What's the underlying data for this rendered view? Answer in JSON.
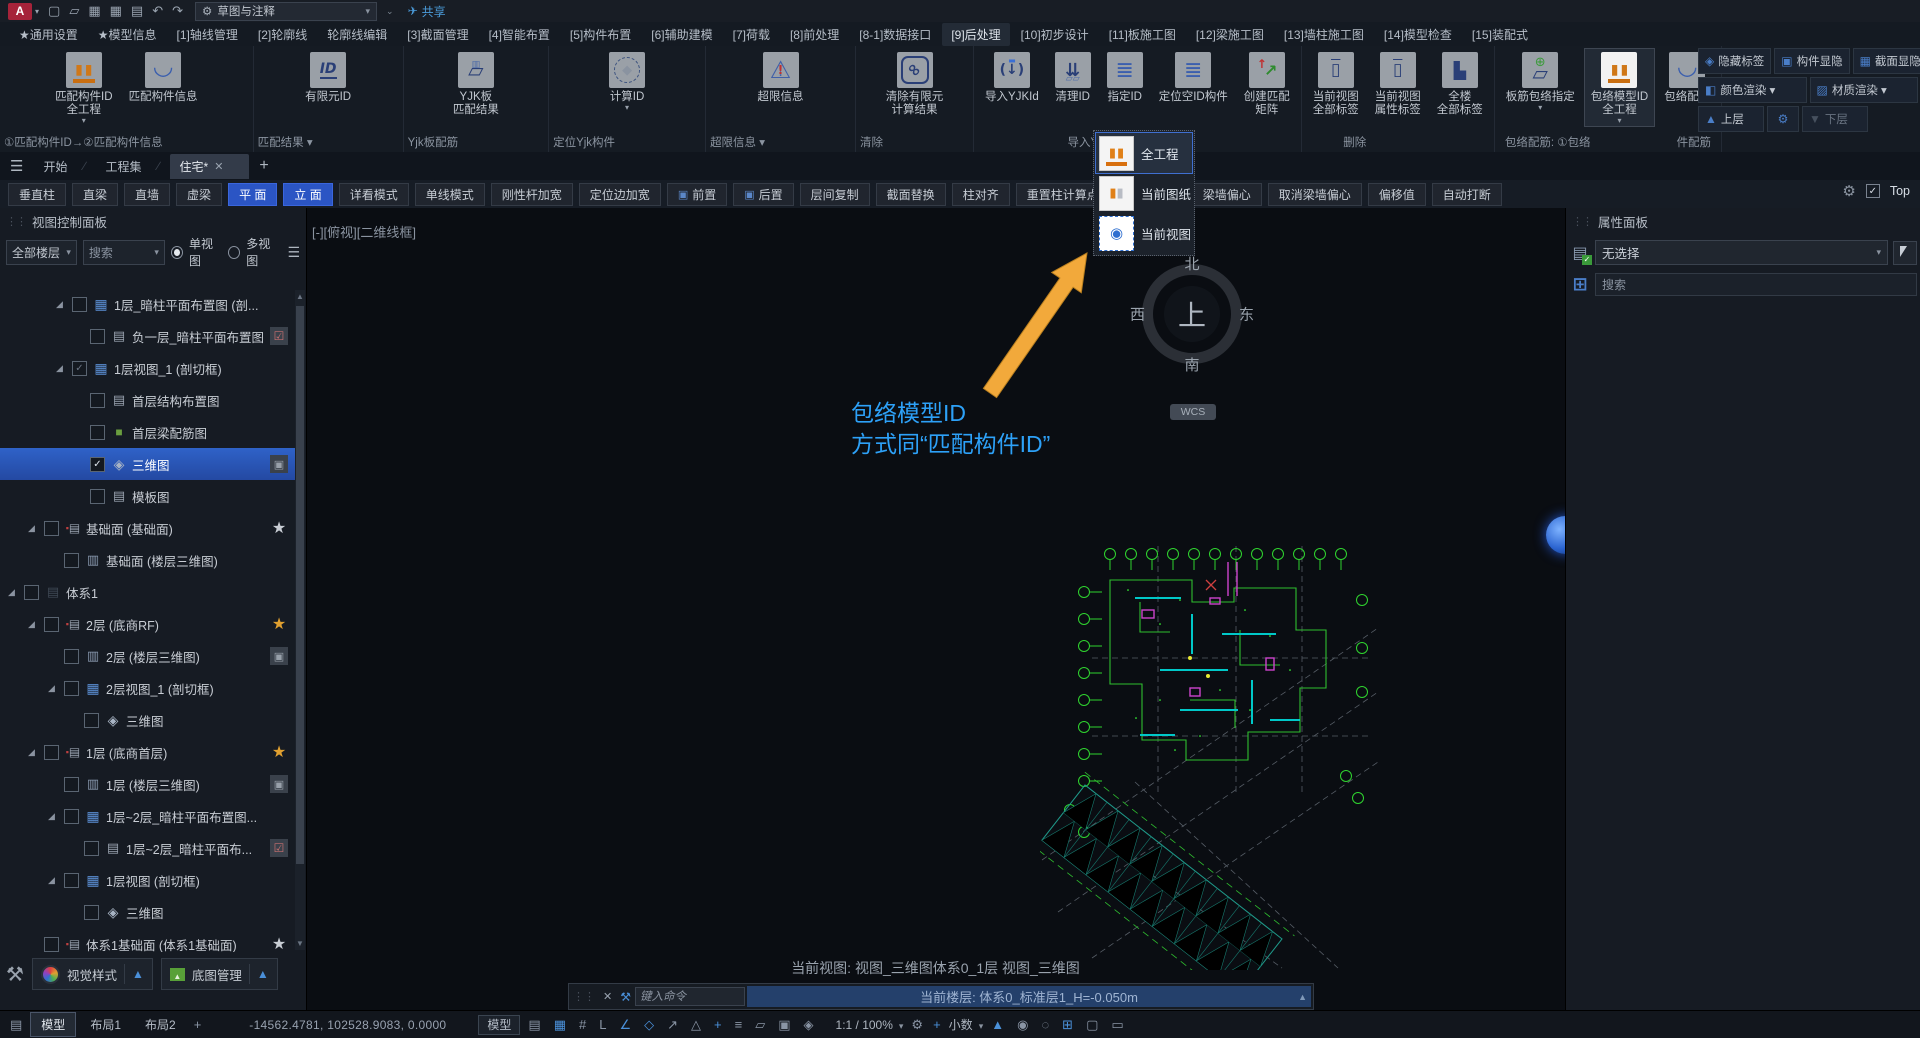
{
  "titlebar": {
    "app_initial": "A",
    "workspace": "草图与注释",
    "share_label": "共享",
    "doc_title": "广州贯微·小迅  住宅.dwg",
    "search_placeholder": "键入关键字或短语",
    "login_label": "登录",
    "account_initial": "A",
    "help_glyph": "?",
    "minimize_glyph": "—",
    "maximize_glyph": "❐",
    "close_glyph": "✕",
    "quick_icons": [
      {
        "name": "new-file-icon",
        "glyph": "▢"
      },
      {
        "name": "open-folder-icon",
        "glyph": "▱"
      },
      {
        "name": "save-icon",
        "glyph": "▦"
      },
      {
        "name": "save-as-icon",
        "glyph": "▦"
      },
      {
        "name": "print-icon",
        "glyph": "▤"
      },
      {
        "name": "undo-icon",
        "glyph": "↶"
      },
      {
        "name": "redo-icon",
        "glyph": "↷"
      }
    ]
  },
  "menubar": {
    "items": [
      {
        "label": "★通用设置"
      },
      {
        "label": "★模型信息"
      },
      {
        "label": "[1]轴线管理"
      },
      {
        "label": "[2]轮廓线"
      },
      {
        "label": "轮廓线编辑"
      },
      {
        "label": "[3]截面管理"
      },
      {
        "label": "[4]智能布置"
      },
      {
        "label": "[5]构件布置"
      },
      {
        "label": "[6]辅助建模"
      },
      {
        "label": "[7]荷载"
      },
      {
        "label": "[8]前处理"
      },
      {
        "label": "[8-1]数据接口"
      },
      {
        "label": "[9]后处理",
        "active": "1"
      },
      {
        "label": "[10]初步设计"
      },
      {
        "label": "[11]板施工图"
      },
      {
        "label": "[12]梁施工图"
      },
      {
        "label": "[13]墙柱施工图"
      },
      {
        "label": "[14]模型检查"
      },
      {
        "label": "[15]装配式"
      }
    ],
    "overflow_glyph": "»",
    "layout_label": "功能布局:",
    "layout_value": "默认"
  },
  "ribbon": {
    "groups": [
      {
        "label": "①匹配构件ID→②匹配构件信息",
        "buttons": [
          {
            "label": "匹配构件ID\n全工程",
            "icon": "columns",
            "arrow": "1"
          },
          {
            "label": "匹配构件信息",
            "icon": "wave"
          }
        ]
      },
      {
        "label": "匹配结果 ▾",
        "buttons": [
          {
            "label": "有限元ID",
            "icon": "id"
          }
        ]
      },
      {
        "label": "Yjk板配筋",
        "buttons": [
          {
            "label": "YJK板\n匹配结果",
            "icon": "plate"
          }
        ]
      },
      {
        "label": "定位Yjk构件",
        "buttons": [
          {
            "label": "计算ID",
            "icon": "calc",
            "arrow": "1"
          }
        ]
      },
      {
        "label": "超限信息 ▾",
        "buttons": [
          {
            "label": "超限信息",
            "icon": "warning"
          }
        ]
      },
      {
        "label": "清除",
        "buttons": [
          {
            "label": "清除有限元\n计算结果",
            "icon": "link"
          }
        ]
      },
      {
        "label": "导入YJKId",
        "buttons": [
          {
            "label": "导入YJKId",
            "icon": "import"
          },
          {
            "label": "清理ID",
            "icon": "cleanid"
          },
          {
            "label": "指定ID",
            "icon": "assignid"
          },
          {
            "label": "定位空ID构件",
            "icon": "locateid"
          },
          {
            "label": "创建匹配\n矩阵",
            "icon": "matrix"
          }
        ]
      },
      {
        "label": "删除",
        "buttons": [
          {
            "label": "当前视图\n全部标签",
            "icon": "trash"
          },
          {
            "label": "当前视图\n属性标签",
            "icon": "trash"
          },
          {
            "label": "全楼\n全部标签",
            "icon": "dozer"
          }
        ]
      },
      {
        "label": "包络配筋: ①包络",
        "label_right": "件配筋",
        "buttons": [
          {
            "label": "板筋包络指定",
            "icon": "plateenv",
            "arrow": "1"
          },
          {
            "label": "包络模型ID\n全工程",
            "icon": "columnsw",
            "arrow": "1",
            "active": "1"
          },
          {
            "label": "包络配筋",
            "icon": "wave"
          }
        ]
      }
    ]
  },
  "view_controls": {
    "row1": [
      {
        "label": "隐藏标签",
        "icon_glyph": "◈",
        "icon_name": "hide-tag-icon"
      },
      {
        "label": "构件显隐",
        "icon_glyph": "▣",
        "icon_name": "component-visibility-icon"
      },
      {
        "label": "截面显隐",
        "icon_glyph": "▦",
        "icon_name": "section-visibility-icon"
      }
    ],
    "row2": [
      {
        "label": "颜色渲染 ▾",
        "icon_glyph": "◧",
        "icon_name": "color-render-icon"
      },
      {
        "label": "材质渲染 ▾",
        "icon_glyph": "▨",
        "icon_name": "material-render-icon"
      }
    ],
    "up_label": "上层",
    "down_label": "下层"
  },
  "dropdown": {
    "items": [
      {
        "label": "全工程",
        "icon": "cols1",
        "sel": "1"
      },
      {
        "label": "当前图纸",
        "icon": "cols2"
      },
      {
        "label": "当前视图",
        "icon": "view"
      }
    ]
  },
  "doc_tabs": {
    "items": [
      {
        "label": "开始"
      },
      {
        "label": "工程集"
      },
      {
        "label": "住宅*",
        "active": "1",
        "closable": "1"
      }
    ]
  },
  "toolbar": {
    "buttons": [
      {
        "label": "垂直柱"
      },
      {
        "label": "直梁"
      },
      {
        "label": "直墙"
      },
      {
        "label": "虚梁"
      },
      {
        "label": "平 面",
        "on": "1"
      },
      {
        "label": "立 面",
        "on": "1"
      },
      {
        "label": "详看模式"
      },
      {
        "label": "单线模式"
      },
      {
        "label": "刚性杆加宽"
      },
      {
        "label": "定位边加宽"
      },
      {
        "label": "前置",
        "ic": "1"
      },
      {
        "label": "后置",
        "ic": "1"
      },
      {
        "label": "层间复制"
      },
      {
        "label": "截面替换"
      },
      {
        "label": "柱对齐"
      },
      {
        "label": "重置柱计算点"
      },
      {
        "label": "梁墙对齐"
      },
      {
        "label": "梁墙偏心"
      },
      {
        "label": "取消梁墙偏心"
      },
      {
        "label": "偏移值"
      },
      {
        "label": "自动打断"
      }
    ],
    "top_label": "Top"
  },
  "left_panel": {
    "title": "视图控制面板",
    "floor_filter": "全部楼层",
    "search_label": "搜索",
    "single_view": "单视图",
    "multi_view": "多视图",
    "tree": [
      {
        "lv": "3",
        "icon": "grid",
        "label": "1层_暗柱平面布置图 (剖...",
        "chk": "off",
        "exp": "1"
      },
      {
        "lv": "5",
        "icon": "layers",
        "label": "负一层_暗柱平面布置图",
        "chk": "off",
        "badge": "clip"
      },
      {
        "lv": "3",
        "icon": "grid",
        "label": "1层视图_1 (剖切框)",
        "chk": "dim",
        "exp": "1"
      },
      {
        "lv": "5",
        "icon": "layers",
        "label": "首层结构布置图",
        "chk": "off"
      },
      {
        "lv": "5",
        "icon": "green",
        "label": "首层梁配筋图",
        "chk": "off"
      },
      {
        "lv": "5",
        "icon": "cube",
        "label": "三维图",
        "chk": "on",
        "sel": "1",
        "badge": "img"
      },
      {
        "lv": "5",
        "icon": "layers",
        "label": "模板图",
        "chk": "off"
      },
      {
        "lv": "1",
        "icon": "redlayer",
        "label": "基础面 (基础面)",
        "chk": "off",
        "badge": "starw",
        "exp": "1"
      },
      {
        "lv": "2",
        "icon": "list",
        "label": "基础面 (楼层三维图)",
        "chk": "off"
      },
      {
        "lv": "0",
        "icon": "sys",
        "label": "体系1",
        "chk": "off",
        "exp": "1"
      },
      {
        "lv": "1",
        "icon": "redlayer",
        "label": "2层 (底商RF)",
        "chk": "off",
        "badge": "staro",
        "exp": "1"
      },
      {
        "lv": "2",
        "icon": "list",
        "label": "2层 (楼层三维图)",
        "chk": "off",
        "badge": "img"
      },
      {
        "lv": "2",
        "icon": "grid",
        "label": "2层视图_1 (剖切框)",
        "chk": "off",
        "exp": "1"
      },
      {
        "lv": "4",
        "icon": "cube",
        "label": "三维图",
        "chk": "off"
      },
      {
        "lv": "1",
        "icon": "redlayer",
        "label": "1层 (底商首层)",
        "chk": "off",
        "badge": "staro",
        "exp": "1"
      },
      {
        "lv": "2",
        "icon": "list",
        "label": "1层 (楼层三维图)",
        "chk": "off",
        "badge": "img"
      },
      {
        "lv": "2",
        "icon": "grid",
        "label": "1层~2层_暗柱平面布置图...",
        "chk": "off",
        "exp": "1"
      },
      {
        "lv": "4",
        "icon": "layers",
        "label": "1层~2层_暗柱平面布...",
        "chk": "off",
        "badge": "clip"
      },
      {
        "lv": "2",
        "icon": "grid",
        "label": "1层视图 (剖切框)",
        "chk": "off",
        "exp": "1"
      },
      {
        "lv": "4",
        "icon": "cube",
        "label": "三维图",
        "chk": "off"
      },
      {
        "lv": "1",
        "icon": "redlayer",
        "label": "体系1基础面 (体系1基础面)",
        "chk": "off",
        "badge": "starw"
      }
    ],
    "visual_style": "视觉样式",
    "base_map": "底图管理"
  },
  "canvas": {
    "viewport_label": "[-][俯视][二维线框]",
    "annotation_line1": "包络模型ID",
    "annotation_line2": "方式同“匹配构件ID”",
    "compass": {
      "north": "北",
      "south": "南",
      "east": "东",
      "west": "西",
      "center": "上",
      "wcs": "WCS"
    },
    "view_status": "当前视图: 视图_三维图体系0_1层 视图_三维图",
    "command_placeholder": "键入命令",
    "floor_status": "当前楼层: 体系0_标准层1_H=-0.050m"
  },
  "right_panel": {
    "title": "属性面板",
    "selection_value": "无选择",
    "search_placeholder": "搜索"
  },
  "statusbar": {
    "tabs": [
      {
        "label": "模型",
        "active": "1"
      },
      {
        "label": "布局1"
      },
      {
        "label": "布局2"
      }
    ],
    "coords": "-14562.4781, 102528.9083, 0.0000",
    "model_button": "模型",
    "mid_icons": [
      {
        "name": "paper-model-toggle-icon",
        "glyph": "▤"
      },
      {
        "name": "grid-display-icon",
        "glyph": "▦",
        "on": "1"
      },
      {
        "name": "snap-mode-icon",
        "glyph": "#"
      },
      {
        "name": "ortho-mode-icon",
        "glyph": "L"
      },
      {
        "name": "polar-tracking-icon",
        "glyph": "∠",
        "on": "1"
      },
      {
        "name": "object-snap-icon",
        "glyph": "◇",
        "on": "1"
      },
      {
        "name": "snap-tracking-icon",
        "glyph": "↗"
      },
      {
        "name": "dynamic-ucs-icon",
        "glyph": "△"
      },
      {
        "name": "dynamic-input-icon",
        "glyph": "+",
        "on": "1"
      },
      {
        "name": "lineweight-icon",
        "glyph": "≡"
      },
      {
        "name": "transparency-icon",
        "glyph": "▱"
      },
      {
        "name": "selection-cycling-icon",
        "glyph": "▣"
      },
      {
        "name": "3d-osnap-icon",
        "glyph": "◈"
      }
    ],
    "scale_value": "1:1 / 100%",
    "units_value": "小数",
    "right_icons": [
      {
        "name": "annotation-visibility-icon",
        "glyph": "▲",
        "on": "1"
      },
      {
        "name": "annotation-monitor-icon",
        "glyph": "◉"
      },
      {
        "name": "isolate-objects-icon",
        "glyph": "◌"
      },
      {
        "name": "hardware-acceleration-icon",
        "glyph": "⊞",
        "on": "1"
      },
      {
        "name": "clean-screen-icon",
        "glyph": "▢"
      },
      {
        "name": "customization-icon",
        "glyph": "▭"
      }
    ]
  }
}
